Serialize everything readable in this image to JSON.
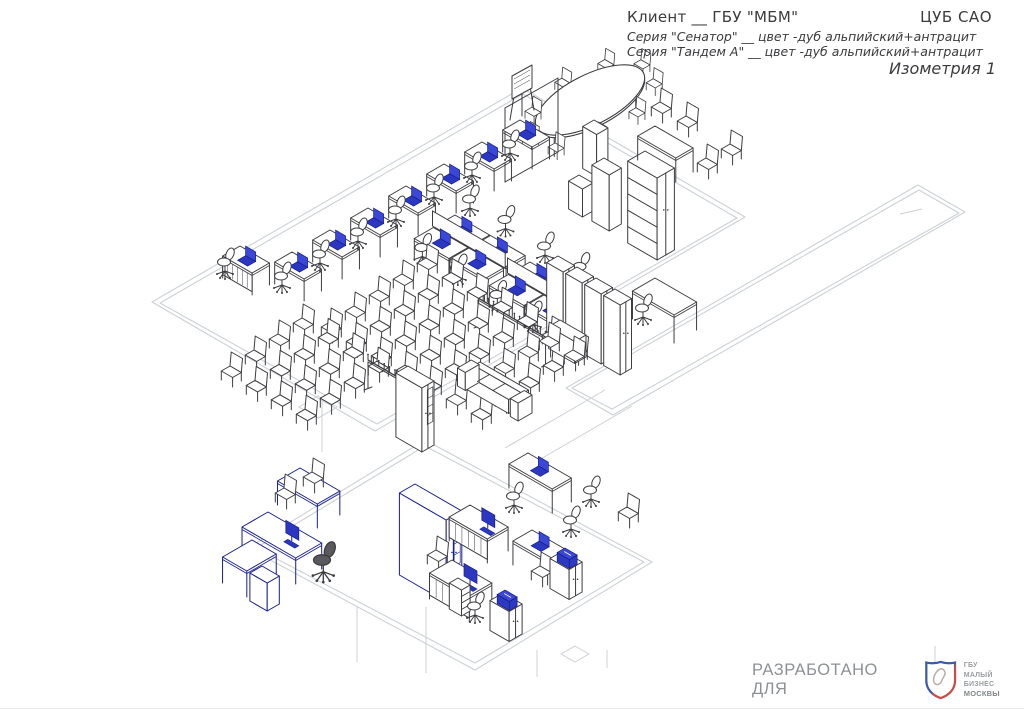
{
  "header": {
    "client_line": "Клиент __ ГБУ \"МБМ\"",
    "location_label": "ЦУБ САО",
    "series_line_1": "Серия \"Сенатор\" __ цвет -дуб альпийский+антрацит",
    "series_line_2": "Серия \"Тандем А\" __ цвет -дуб альпийский+антрацит",
    "view_label": "Изометрия 1"
  },
  "footer": {
    "developed_for_label": "РАЗРАБОТАНО ДЛЯ",
    "logo_line_1": "ГБУ",
    "logo_line_2": "МАЛЫЙ БИЗНЕС",
    "logo_line_3": "МОСКВЫ"
  },
  "colors": {
    "line": "#3c3c40",
    "light_outline": "#ccd1d6",
    "accent_blue": "#2b36c1",
    "accent_blue_dark": "#161e8d",
    "text": "#3b3b3e",
    "footer_text": "#8d9195",
    "logo_blue": "#3b5aa8",
    "logo_red": "#c84b4b"
  },
  "scene": {
    "description": "Isometric furniture layout: training room with workstations, classroom chairs, conference table, cabinets; lower executive office; corridor outline",
    "rooms": {
      "main": [
        [
          152,
          302
        ],
        [
          522,
          88
        ],
        [
          745,
          217
        ],
        [
          375,
          431
        ]
      ],
      "main_inner": [
        [
          160,
          303
        ],
        [
          523,
          94
        ],
        [
          737,
          218
        ],
        [
          377,
          424
        ]
      ],
      "corridor": [
        [
          918,
          185
        ],
        [
          965,
          212
        ],
        [
          613,
          415
        ],
        [
          566,
          388
        ]
      ],
      "corridor_inner": [
        [
          919,
          190
        ],
        [
          959,
          213
        ],
        [
          612,
          409
        ],
        [
          572,
          388
        ]
      ],
      "lower": [
        [
          248,
          548
        ],
        [
          425,
          440
        ],
        [
          652,
          562
        ],
        [
          475,
          670
        ]
      ],
      "lower_inner": [
        [
          256,
          548
        ],
        [
          425,
          446
        ],
        [
          644,
          562
        ],
        [
          475,
          663
        ]
      ]
    },
    "light_lines": [
      [
        935,
        646,
        935,
        663
      ],
      [
        357,
        606,
        357,
        662
      ],
      [
        426,
        607,
        426,
        673
      ],
      [
        537,
        650,
        537,
        677
      ],
      [
        607,
        650,
        607,
        668
      ],
      [
        605,
        390,
        505,
        448
      ],
      [
        632,
        406,
        532,
        464
      ],
      [
        900,
        214,
        922,
        209
      ],
      [
        322,
        400,
        322,
        452
      ]
    ],
    "floor_marks": [
      {
        "o": [
          318,
          396
        ],
        "a": 22,
        "b": 22
      },
      {
        "o": [
          575,
          646
        ],
        "a": 16,
        "b": 16
      }
    ],
    "items": [
      {
        "t": "conf",
        "c": [
          590,
          100
        ],
        "rx": 60,
        "ry": 25,
        "rot": -27,
        "chairs": 9,
        "name": "conference-table"
      },
      {
        "t": "easel",
        "o": [
          512,
          76
        ],
        "name": "flipchart-easel"
      },
      {
        "t": "seg",
        "s": [
          [
            505,
            108,
            505,
            182
          ],
          [
            558,
            78,
            558,
            152
          ],
          [
            505,
            108,
            558,
            78
          ],
          [
            505,
            182,
            558,
            152
          ]
        ],
        "name": "partition-frame"
      },
      {
        "t": "box",
        "o": [
          594,
          120
        ],
        "a": 16,
        "b": 13,
        "h": 42,
        "name": "column-box"
      },
      {
        "t": "box",
        "o": [
          579,
          175
        ],
        "a": 16,
        "b": 12,
        "h": 28,
        "name": "pedestal-cabinet"
      },
      {
        "t": "box",
        "o": [
          604,
          158
        ],
        "a": 20,
        "b": 14,
        "h": 56,
        "name": "cabinet"
      },
      {
        "t": "box",
        "o": [
          645,
          151
        ],
        "a": 34,
        "b": 20,
        "h": 82,
        "shelves": 4,
        "split": true,
        "name": "tall-shelf-cabinet"
      },
      {
        "t": "desk",
        "o": [
          655,
          126
        ],
        "a": 44,
        "b": 20,
        "h": 24,
        "name": "meeting-table"
      },
      {
        "t": "cchair",
        "o": [
          660,
          102
        ]
      },
      {
        "t": "cchair",
        "o": [
          686,
          116
        ]
      },
      {
        "t": "cchair",
        "o": [
          706,
          158
        ]
      },
      {
        "t": "cchair",
        "o": [
          730,
          144
        ]
      },
      {
        "t": "desk",
        "o": [
          292,
          252
        ],
        "a": 34,
        "b": 20,
        "h": 22,
        "laptop": true,
        "name": "training-desk"
      },
      {
        "t": "desk",
        "o": [
          330,
          230
        ],
        "a": 34,
        "b": 20,
        "h": 22,
        "laptop": true,
        "name": "training-desk"
      },
      {
        "t": "desk",
        "o": [
          368,
          208
        ],
        "a": 34,
        "b": 20,
        "h": 22,
        "laptop": true,
        "name": "training-desk"
      },
      {
        "t": "desk",
        "o": [
          406,
          186
        ],
        "a": 34,
        "b": 20,
        "h": 22,
        "laptop": true,
        "name": "training-desk"
      },
      {
        "t": "desk",
        "o": [
          444,
          164
        ],
        "a": 34,
        "b": 20,
        "h": 22,
        "laptop": true,
        "name": "training-desk"
      },
      {
        "t": "desk",
        "o": [
          482,
          142
        ],
        "a": 34,
        "b": 20,
        "h": 22,
        "laptop": true,
        "name": "training-desk"
      },
      {
        "t": "desk",
        "o": [
          520,
          120
        ],
        "a": 34,
        "b": 20,
        "h": 22,
        "laptop": true,
        "name": "training-desk"
      },
      {
        "t": "ochair",
        "o": [
          281,
          276
        ]
      },
      {
        "t": "ochair",
        "o": [
          319,
          254
        ]
      },
      {
        "t": "ochair",
        "o": [
          357,
          232
        ]
      },
      {
        "t": "ochair",
        "o": [
          395,
          210
        ]
      },
      {
        "t": "ochair",
        "o": [
          433,
          188
        ]
      },
      {
        "t": "ochair",
        "o": [
          471,
          166
        ]
      },
      {
        "t": "ochair",
        "o": [
          509,
          144
        ]
      },
      {
        "t": "pod",
        "o": [
          455,
          215
        ],
        "name": "workstation-pod"
      },
      {
        "t": "pod",
        "o": [
          530,
          262
        ],
        "name": "workstation-pod"
      },
      {
        "t": "box",
        "o": [
          558,
          256
        ],
        "a": 19,
        "b": 13,
        "h": 70,
        "split": true,
        "name": "wardrobe"
      },
      {
        "t": "box",
        "o": [
          577,
          267
        ],
        "a": 19,
        "b": 13,
        "h": 70,
        "split": true,
        "name": "wardrobe"
      },
      {
        "t": "box",
        "o": [
          596,
          278
        ],
        "a": 19,
        "b": 13,
        "h": 70,
        "split": true,
        "name": "wardrobe"
      },
      {
        "t": "box",
        "o": [
          615,
          289
        ],
        "a": 19,
        "b": 13,
        "h": 70,
        "split": true,
        "name": "wardrobe"
      },
      {
        "t": "rack",
        "o": [
          478,
          298
        ],
        "len": 78,
        "name": "coat-rack"
      },
      {
        "t": "grid",
        "o": [
          330,
          322
        ],
        "cols": 7,
        "rows": 5,
        "cs": [
          25,
          14.4
        ],
        "rs": [
          24,
          -16
        ],
        "name": "classroom-chairs-right"
      },
      {
        "t": "desk",
        "o": [
          240,
          246
        ],
        "a": 34,
        "b": 20,
        "h": 22,
        "laptop": true,
        "panel": true,
        "name": "presenter-desk"
      },
      {
        "t": "ochair",
        "o": [
          224,
          262
        ]
      },
      {
        "t": "grid",
        "o": [
          230,
          366
        ],
        "cols": 4,
        "rows": 4,
        "cs": [
          25,
          14.4
        ],
        "rs": [
          24,
          -16
        ],
        "name": "classroom-chairs-left"
      },
      {
        "t": "rack",
        "o": [
          368,
          360
        ],
        "len": 56,
        "name": "coat-rack"
      },
      {
        "t": "box",
        "o": [
          408,
          366
        ],
        "a": 30,
        "b": 14,
        "h": 64,
        "glass": true,
        "split": true,
        "name": "display-cabinet"
      },
      {
        "t": "sofa",
        "o": [
          480,
          362
        ],
        "name": "sofa"
      },
      {
        "t": "box",
        "o": [
          560,
          320
        ],
        "a": 30,
        "b": 13,
        "h": 22,
        "name": "side-table"
      },
      {
        "t": "cchair",
        "o": [
          548,
          336
        ]
      },
      {
        "t": "cchair",
        "o": [
          573,
          350
        ]
      },
      {
        "t": "desk",
        "o": [
          655,
          278
        ],
        "a": 48,
        "b": 26,
        "h": 28,
        "name": "corridor-desk"
      },
      {
        "t": "ochair",
        "o": [
          642,
          308
        ]
      },
      {
        "t": "desk",
        "o": [
          300,
          468
        ],
        "a": 46,
        "b": 26,
        "h": 24,
        "c": "blue",
        "name": "exec-meeting-extension"
      },
      {
        "t": "cchair",
        "o": [
          284,
          488
        ]
      },
      {
        "t": "cchair",
        "o": [
          312,
          472
        ]
      },
      {
        "t": "desk",
        "o": [
          268,
          512
        ],
        "a": 62,
        "b": 30,
        "h": 26,
        "c": "blue",
        "monitor": true,
        "name": "executive-desk"
      },
      {
        "t": "desk",
        "o": [
          252,
          540
        ],
        "a": 28,
        "b": 34,
        "h": 26,
        "c": "blue",
        "name": "executive-desk-return"
      },
      {
        "t": "box",
        "o": [
          262,
          566
        ],
        "a": 20,
        "b": 14,
        "h": 28,
        "c": "blue",
        "name": "exec-pedestal"
      },
      {
        "t": "ochair",
        "o": [
          322,
          560
        ],
        "dark": true,
        "s": 1.3,
        "name": "executive-chair"
      },
      {
        "t": "box",
        "o": [
          415,
          484
        ],
        "a": 54,
        "b": 18,
        "h": 82,
        "c": "blue",
        "split": true,
        "glass": true,
        "name": "bookcase"
      },
      {
        "t": "desk",
        "o": [
          528,
          453
        ],
        "a": 50,
        "b": 22,
        "h": 24,
        "laptop": true,
        "name": "office-desk"
      },
      {
        "t": "ochair",
        "o": [
          590,
          490
        ]
      },
      {
        "t": "cchair",
        "o": [
          627,
          507
        ]
      },
      {
        "t": "desk",
        "o": [
          470,
          505
        ],
        "a": 44,
        "b": 24,
        "h": 24,
        "monitor": true,
        "panel": true,
        "name": "office-desk"
      },
      {
        "t": "ochair",
        "o": [
          513,
          496
        ]
      },
      {
        "t": "cchair",
        "o": [
          436,
          550
        ]
      },
      {
        "t": "desk",
        "o": [
          532,
          530
        ],
        "a": 40,
        "b": 22,
        "h": 24,
        "laptop": true,
        "name": "office-desk"
      },
      {
        "t": "ochair",
        "o": [
          570,
          520
        ]
      },
      {
        "t": "cchair",
        "o": [
          540,
          566
        ]
      },
      {
        "t": "desk",
        "o": [
          452,
          560
        ],
        "a": 46,
        "b": 26,
        "h": 26,
        "monitor": true,
        "panel": true,
        "name": "office-desk"
      },
      {
        "t": "box",
        "o": [
          458,
          578
        ],
        "a": 14,
        "b": 10,
        "h": 26,
        "drawers": 3,
        "name": "drawer-pedestal"
      },
      {
        "t": "ochair",
        "o": [
          474,
          606
        ]
      },
      {
        "t": "box",
        "o": [
          503,
          593
        ],
        "a": 22,
        "b": 15,
        "h": 30,
        "split": true,
        "name": "printer-stand"
      },
      {
        "t": "printer",
        "o": [
          505,
          590
        ],
        "name": "printer"
      },
      {
        "t": "box",
        "o": [
          563,
          551
        ],
        "a": 22,
        "b": 15,
        "h": 30,
        "split": true,
        "name": "printer-stand"
      },
      {
        "t": "printer",
        "o": [
          565,
          548
        ],
        "name": "printer"
      }
    ]
  }
}
